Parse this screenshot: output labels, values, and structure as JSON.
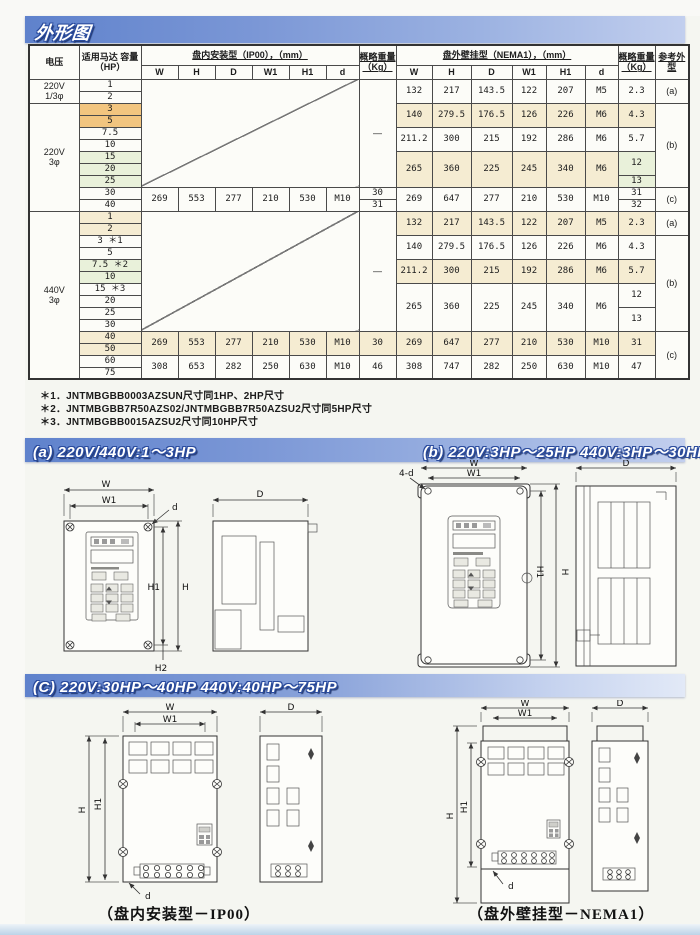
{
  "page": {
    "title": "外形图",
    "captions": {
      "ip00": "（盘内安装型－IP00）",
      "nema": "（盘外壁挂型－NEMA1）"
    },
    "colors": {
      "header_blue": "#5f82cc",
      "header_blue_light": "#c2cfee",
      "highlight_orange": "#f2c57f",
      "highlight_cream": "#f5ecd2",
      "highlight_green": "#e9f1da"
    }
  },
  "sections": {
    "a": "(a) 220V/440V:1～3HP",
    "b": "(b) 220V:3HP～25HP  440V:3HP～30HP",
    "c": "(C) 220V:30HP～40HP   440V:40HP～75HP"
  },
  "footnotes": [
    "＊1．JNTMBGBB0003AZSUN尺寸同1HP、2HP尺寸",
    "＊2．JNTMBGBB7R50AZS02/JNTMBGBB7R50AZSU2尺寸同5HP尺寸",
    "＊3．JNTMBGBB0015AZSU2尺寸同10HP尺寸"
  ],
  "dims": {
    "w": "W",
    "w1": "W1",
    "h": "H",
    "h1": "H1",
    "h2": "H2",
    "D": "D",
    "d": "d",
    "four_d": "4-d"
  },
  "table": {
    "headers": {
      "voltage": "电压",
      "motor_hp": "适用马达 容量（HP）",
      "ip00_group": "盘内安装型（IP00），（mm）",
      "nema_group": "盘外壁挂型（NEMA1），（mm）",
      "weight": "概略重量（Kg）",
      "ref": "参考外型",
      "dims": [
        "W",
        "H",
        "D",
        "W1",
        "H1",
        "d"
      ]
    },
    "dash": "—",
    "voltages": [
      {
        "l1": "220V",
        "l2": "1/3φ"
      },
      {
        "l1": "220V",
        "l2": "3φ"
      },
      {
        "l1": "440V",
        "l2": "3φ"
      }
    ],
    "hp220": [
      "1",
      "2",
      "3",
      "5",
      "7.5",
      "10",
      "15",
      "20",
      "25",
      "30",
      "40"
    ],
    "hp440": [
      "1",
      "2",
      "3 ＊1",
      "5",
      "7.5 ＊2",
      "10",
      "15 ＊3",
      "20",
      "25",
      "30",
      "40",
      "50",
      "60",
      "75"
    ],
    "ip00_220": {
      "w": "269",
      "h": "553",
      "d": "277",
      "w1": "210",
      "h1": "530",
      "screw": "M10",
      "wt_30hp": "30",
      "wt_40hp": "31"
    },
    "ip00_440_40_50": {
      "w": "269",
      "h": "553",
      "d": "277",
      "w1": "210",
      "h1": "530",
      "screw": "M10",
      "wt": "30"
    },
    "ip00_440_60_75": {
      "w": "308",
      "h": "653",
      "d": "282",
      "w1": "250",
      "h1": "630",
      "screw": "M10",
      "wt": "46"
    },
    "nema_220": [
      {
        "w": "132",
        "h": "217",
        "d": "143.5",
        "w1": "122",
        "h1": "207",
        "screw": "M5",
        "wt": "2.3",
        "ref": "(a)"
      },
      {
        "w": "140",
        "h": "279.5",
        "d": "176.5",
        "w1": "126",
        "h1": "226",
        "screw": "M6",
        "wt": "4.3"
      },
      {
        "w": "211.2",
        "h": "300",
        "d": "215",
        "w1": "192",
        "h1": "286",
        "screw": "M6",
        "wt": "5.7",
        "ref": "(b)"
      },
      {
        "w": "265",
        "h": "360",
        "d": "225",
        "w1": "245",
        "h1": "340",
        "screw": "M6",
        "wt_hi": "12",
        "wt_lo": "13"
      },
      {
        "w": "269",
        "h": "647",
        "d": "277",
        "w1": "210",
        "h1": "530",
        "screw": "M10",
        "wt_hi": "31",
        "wt_lo": "32",
        "ref": "(c)"
      }
    ],
    "nema_440": [
      {
        "w": "132",
        "h": "217",
        "d": "143.5",
        "w1": "122",
        "h1": "207",
        "screw": "M5",
        "wt": "2.3",
        "ref": "(a)"
      },
      {
        "w": "140",
        "h": "279.5",
        "d": "176.5",
        "w1": "126",
        "h1": "226",
        "screw": "M6",
        "wt": "4.3"
      },
      {
        "w": "211.2",
        "h": "300",
        "d": "215",
        "w1": "192",
        "h1": "286",
        "screw": "M6",
        "wt": "5.7",
        "ref": "(b)"
      },
      {
        "w": "265",
        "h": "360",
        "d": "225",
        "w1": "245",
        "h1": "340",
        "screw": "M6",
        "wt_hi": "12",
        "wt_lo": "13"
      },
      {
        "w": "269",
        "h": "647",
        "d": "277",
        "w1": "210",
        "h1": "530",
        "screw": "M10",
        "wt": "31",
        "ref": "(c)"
      },
      {
        "w": "308",
        "h": "747",
        "d": "282",
        "w1": "250",
        "h1": "630",
        "screw": "M10",
        "wt": "47"
      }
    ]
  }
}
